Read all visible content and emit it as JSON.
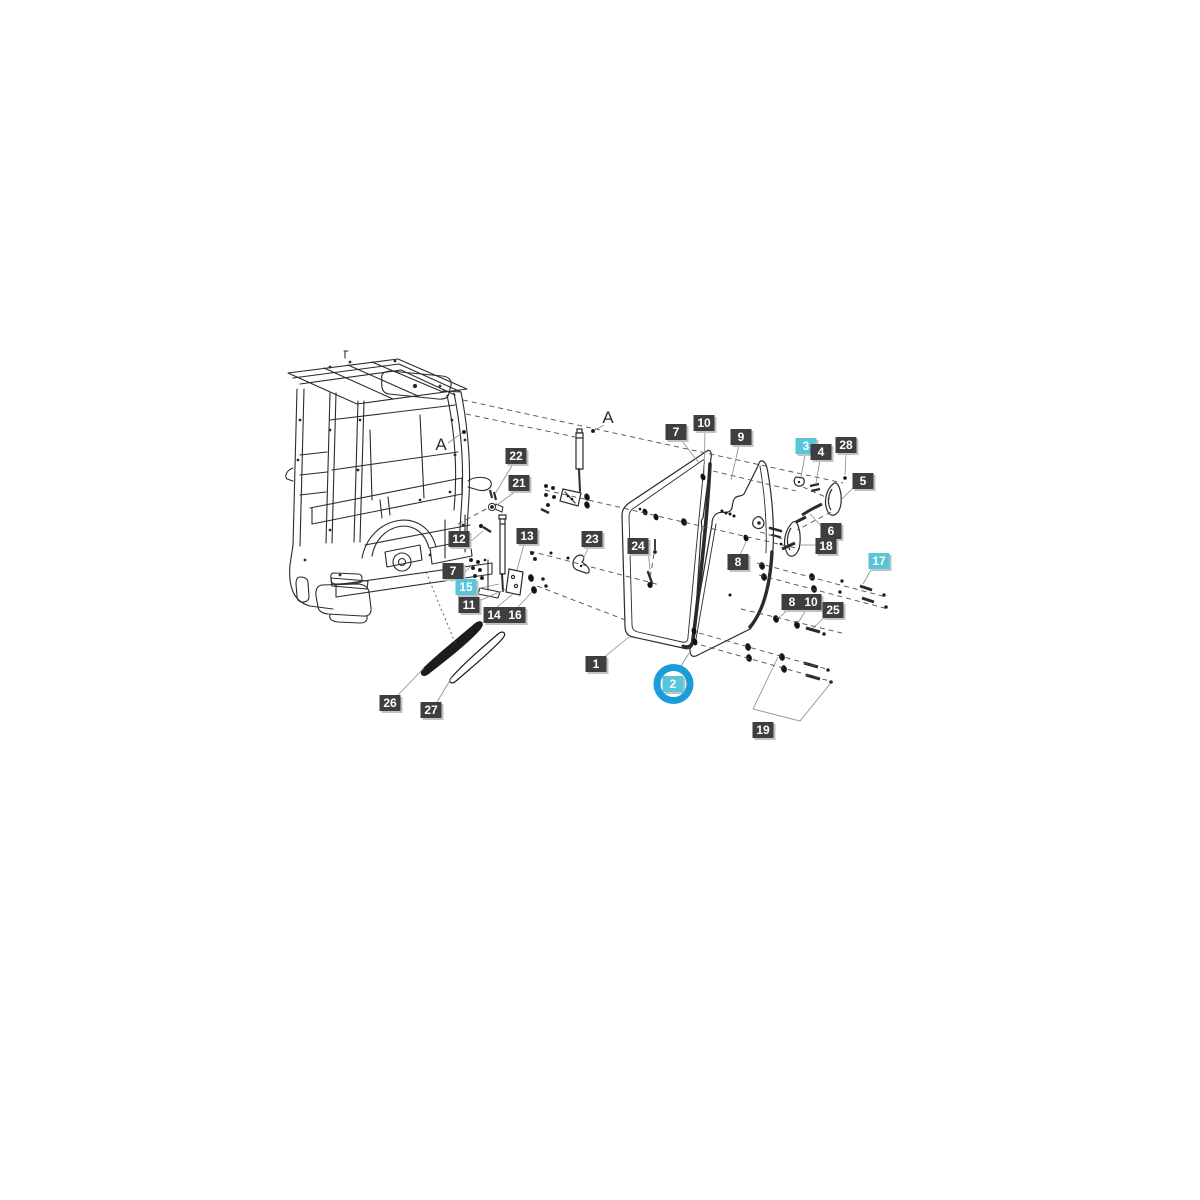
{
  "diagram": {
    "kind": "exploded-parts-diagram",
    "subject": "tractor cab door assembly",
    "colors": {
      "background": "#ffffff",
      "line_art": "#2b2b2b",
      "leader_line": "#8a8a8a",
      "label_bg": "#3e3e40",
      "label_text": "#ffffff",
      "highlight_bg": "#58c6d8",
      "highlight_ring": "#189dd8",
      "label_shadow": "#c2c2c2"
    },
    "view_labels": [
      {
        "text": "A",
        "x": 608,
        "y": 418
      },
      {
        "text": "A",
        "x": 441,
        "y": 445
      }
    ],
    "part_labels": [
      {
        "text": "22",
        "x": 516,
        "y": 456,
        "highlight": false
      },
      {
        "text": "21",
        "x": 519,
        "y": 483,
        "highlight": false
      },
      {
        "text": "12",
        "x": 459,
        "y": 539,
        "highlight": false
      },
      {
        "text": "13",
        "x": 527,
        "y": 536,
        "highlight": false
      },
      {
        "text": "7",
        "x": 453,
        "y": 571,
        "highlight": false
      },
      {
        "text": "15",
        "x": 466,
        "y": 587,
        "highlight": true
      },
      {
        "text": "11",
        "x": 469,
        "y": 605,
        "highlight": false
      },
      {
        "text": "14",
        "x": 494,
        "y": 615,
        "highlight": false
      },
      {
        "text": "16",
        "x": 515,
        "y": 615,
        "highlight": false
      },
      {
        "text": "23",
        "x": 592,
        "y": 539,
        "highlight": false
      },
      {
        "text": "24",
        "x": 638,
        "y": 546,
        "highlight": false
      },
      {
        "text": "1",
        "x": 596,
        "y": 664,
        "highlight": false
      },
      {
        "text": "2",
        "x": 673,
        "y": 684,
        "highlight": true,
        "circled": true
      },
      {
        "text": "26",
        "x": 390,
        "y": 703,
        "highlight": false
      },
      {
        "text": "27",
        "x": 431,
        "y": 710,
        "highlight": false
      },
      {
        "text": "19",
        "x": 763,
        "y": 730,
        "highlight": false
      },
      {
        "text": "7",
        "x": 676,
        "y": 432,
        "highlight": false
      },
      {
        "text": "10",
        "x": 704,
        "y": 423,
        "highlight": false
      },
      {
        "text": "9",
        "x": 741,
        "y": 437,
        "highlight": false
      },
      {
        "text": "3",
        "x": 806,
        "y": 446,
        "highlight": true
      },
      {
        "text": "4",
        "x": 821,
        "y": 452,
        "highlight": false
      },
      {
        "text": "28",
        "x": 846,
        "y": 445,
        "highlight": false
      },
      {
        "text": "5",
        "x": 863,
        "y": 481,
        "highlight": false
      },
      {
        "text": "6",
        "x": 831,
        "y": 531,
        "highlight": false
      },
      {
        "text": "18",
        "x": 826,
        "y": 546,
        "highlight": false
      },
      {
        "text": "17",
        "x": 879,
        "y": 561,
        "highlight": true
      },
      {
        "text": "8",
        "x": 738,
        "y": 562,
        "highlight": false
      },
      {
        "text": "8",
        "x": 792,
        "y": 602,
        "highlight": false
      },
      {
        "text": "10",
        "x": 811,
        "y": 602,
        "highlight": false
      },
      {
        "text": "25",
        "x": 833,
        "y": 610,
        "highlight": false
      }
    ]
  }
}
